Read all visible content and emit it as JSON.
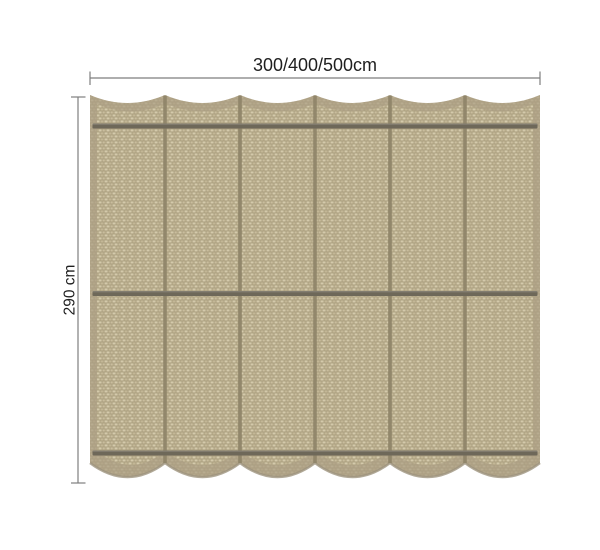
{
  "diagram": {
    "title": "shade-cloth-dimension-diagram",
    "top_dimension": {
      "label": "300/400/500cm"
    },
    "left_dimension": {
      "label": "290 cm"
    },
    "panels": 6,
    "rods": 3,
    "colors": {
      "fabric_base": "#c9bd9e",
      "fabric_light": "#d5caac",
      "fabric_mid": "#c2b695",
      "fabric_seam": "#a59979",
      "edge_band": "#ac9f84",
      "edge_band_shadow": "#9d937e",
      "rod": "#6e6859",
      "divider": "#8f8569",
      "dimension_line": "#7e7e7e",
      "label_text": "#1f1f1f",
      "page_bg": "#ffffff"
    }
  }
}
